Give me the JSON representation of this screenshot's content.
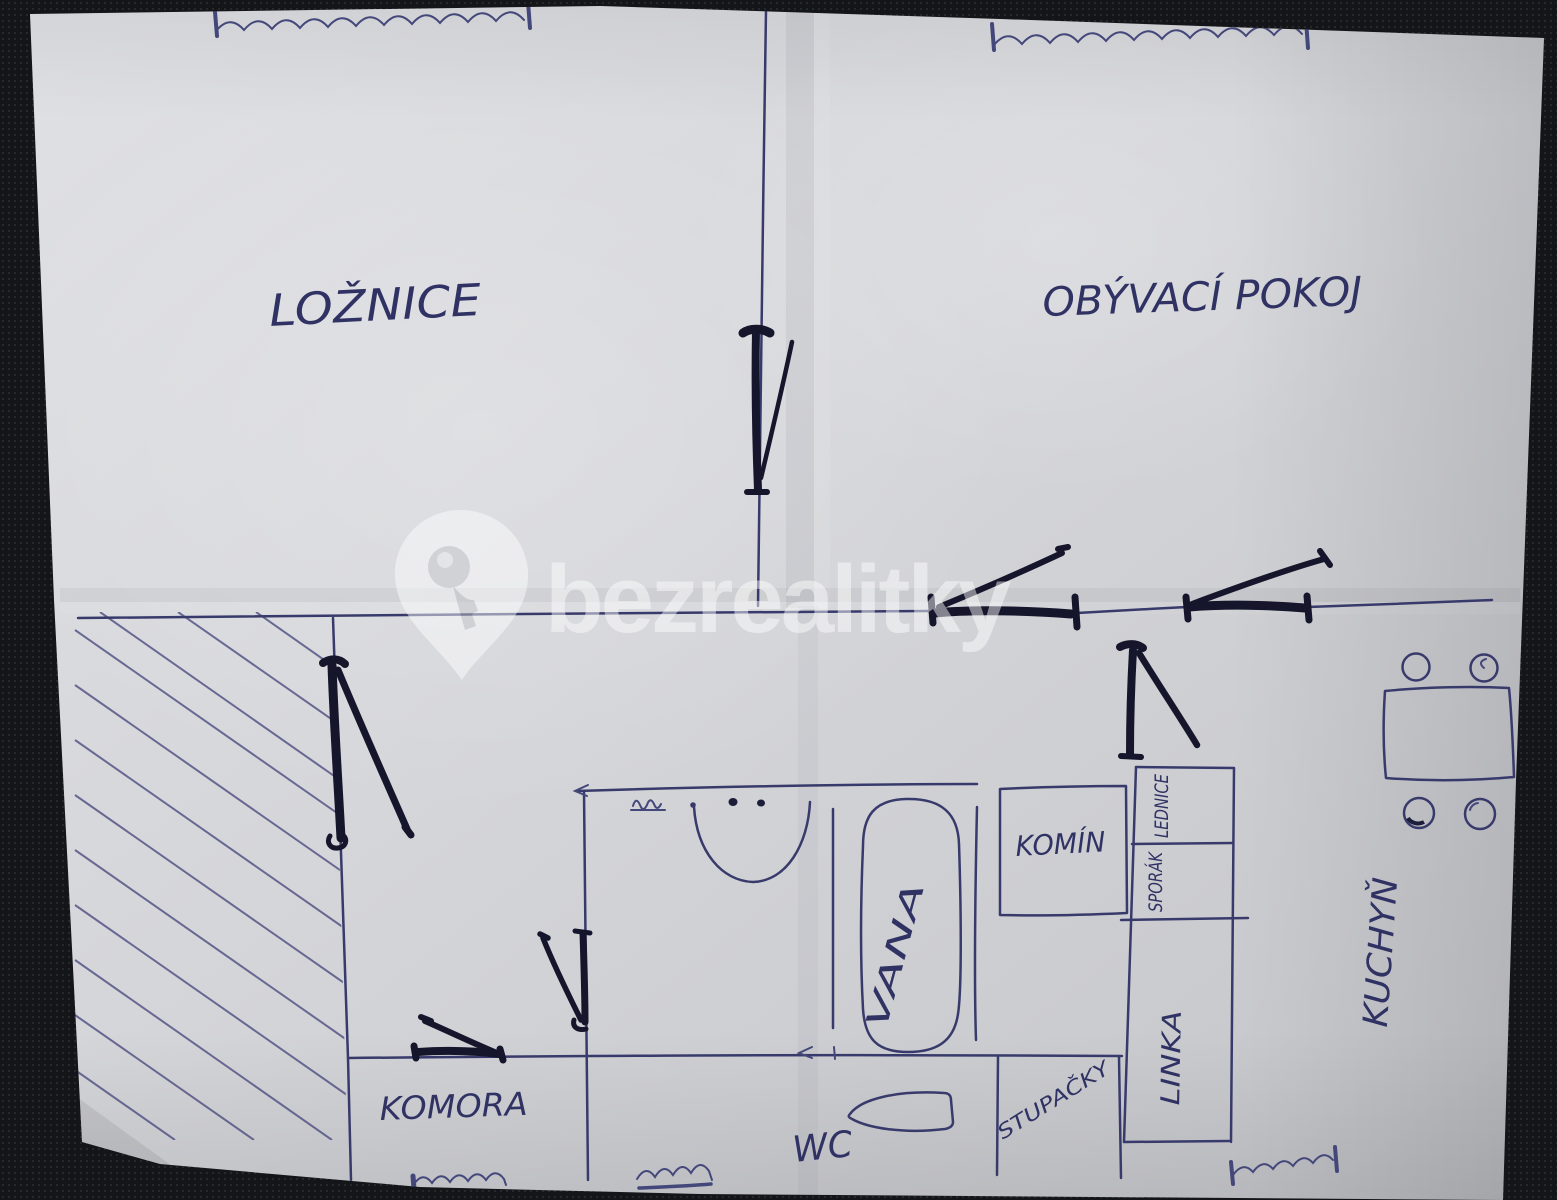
{
  "scene": {
    "type": "hand-drawn floor plan sketch photographed on dark carpet",
    "background_color": "#141518",
    "paper_color": "#d5d6da",
    "pen_ink_color": "#383a6b",
    "marker_color": "#15162b",
    "handwriting_color": "#303264",
    "watermark_color": "#ffffff"
  },
  "watermark": {
    "brand": "bezrealitky",
    "icon": "key-pin-icon"
  },
  "rooms": {
    "bedroom": "LOŽNICE",
    "living_room": "OBÝVACÍ POKOJ",
    "pantry": "KOMORA",
    "toilet": "WC",
    "bathtub": "VANA",
    "chimney": "KOMÍN",
    "fridge": "LEDNICE",
    "stove": "SPORÁK",
    "kitchen_counter": "LINKA",
    "kitchen": "KUCHYŇ",
    "risers": "STUPAČKY"
  }
}
